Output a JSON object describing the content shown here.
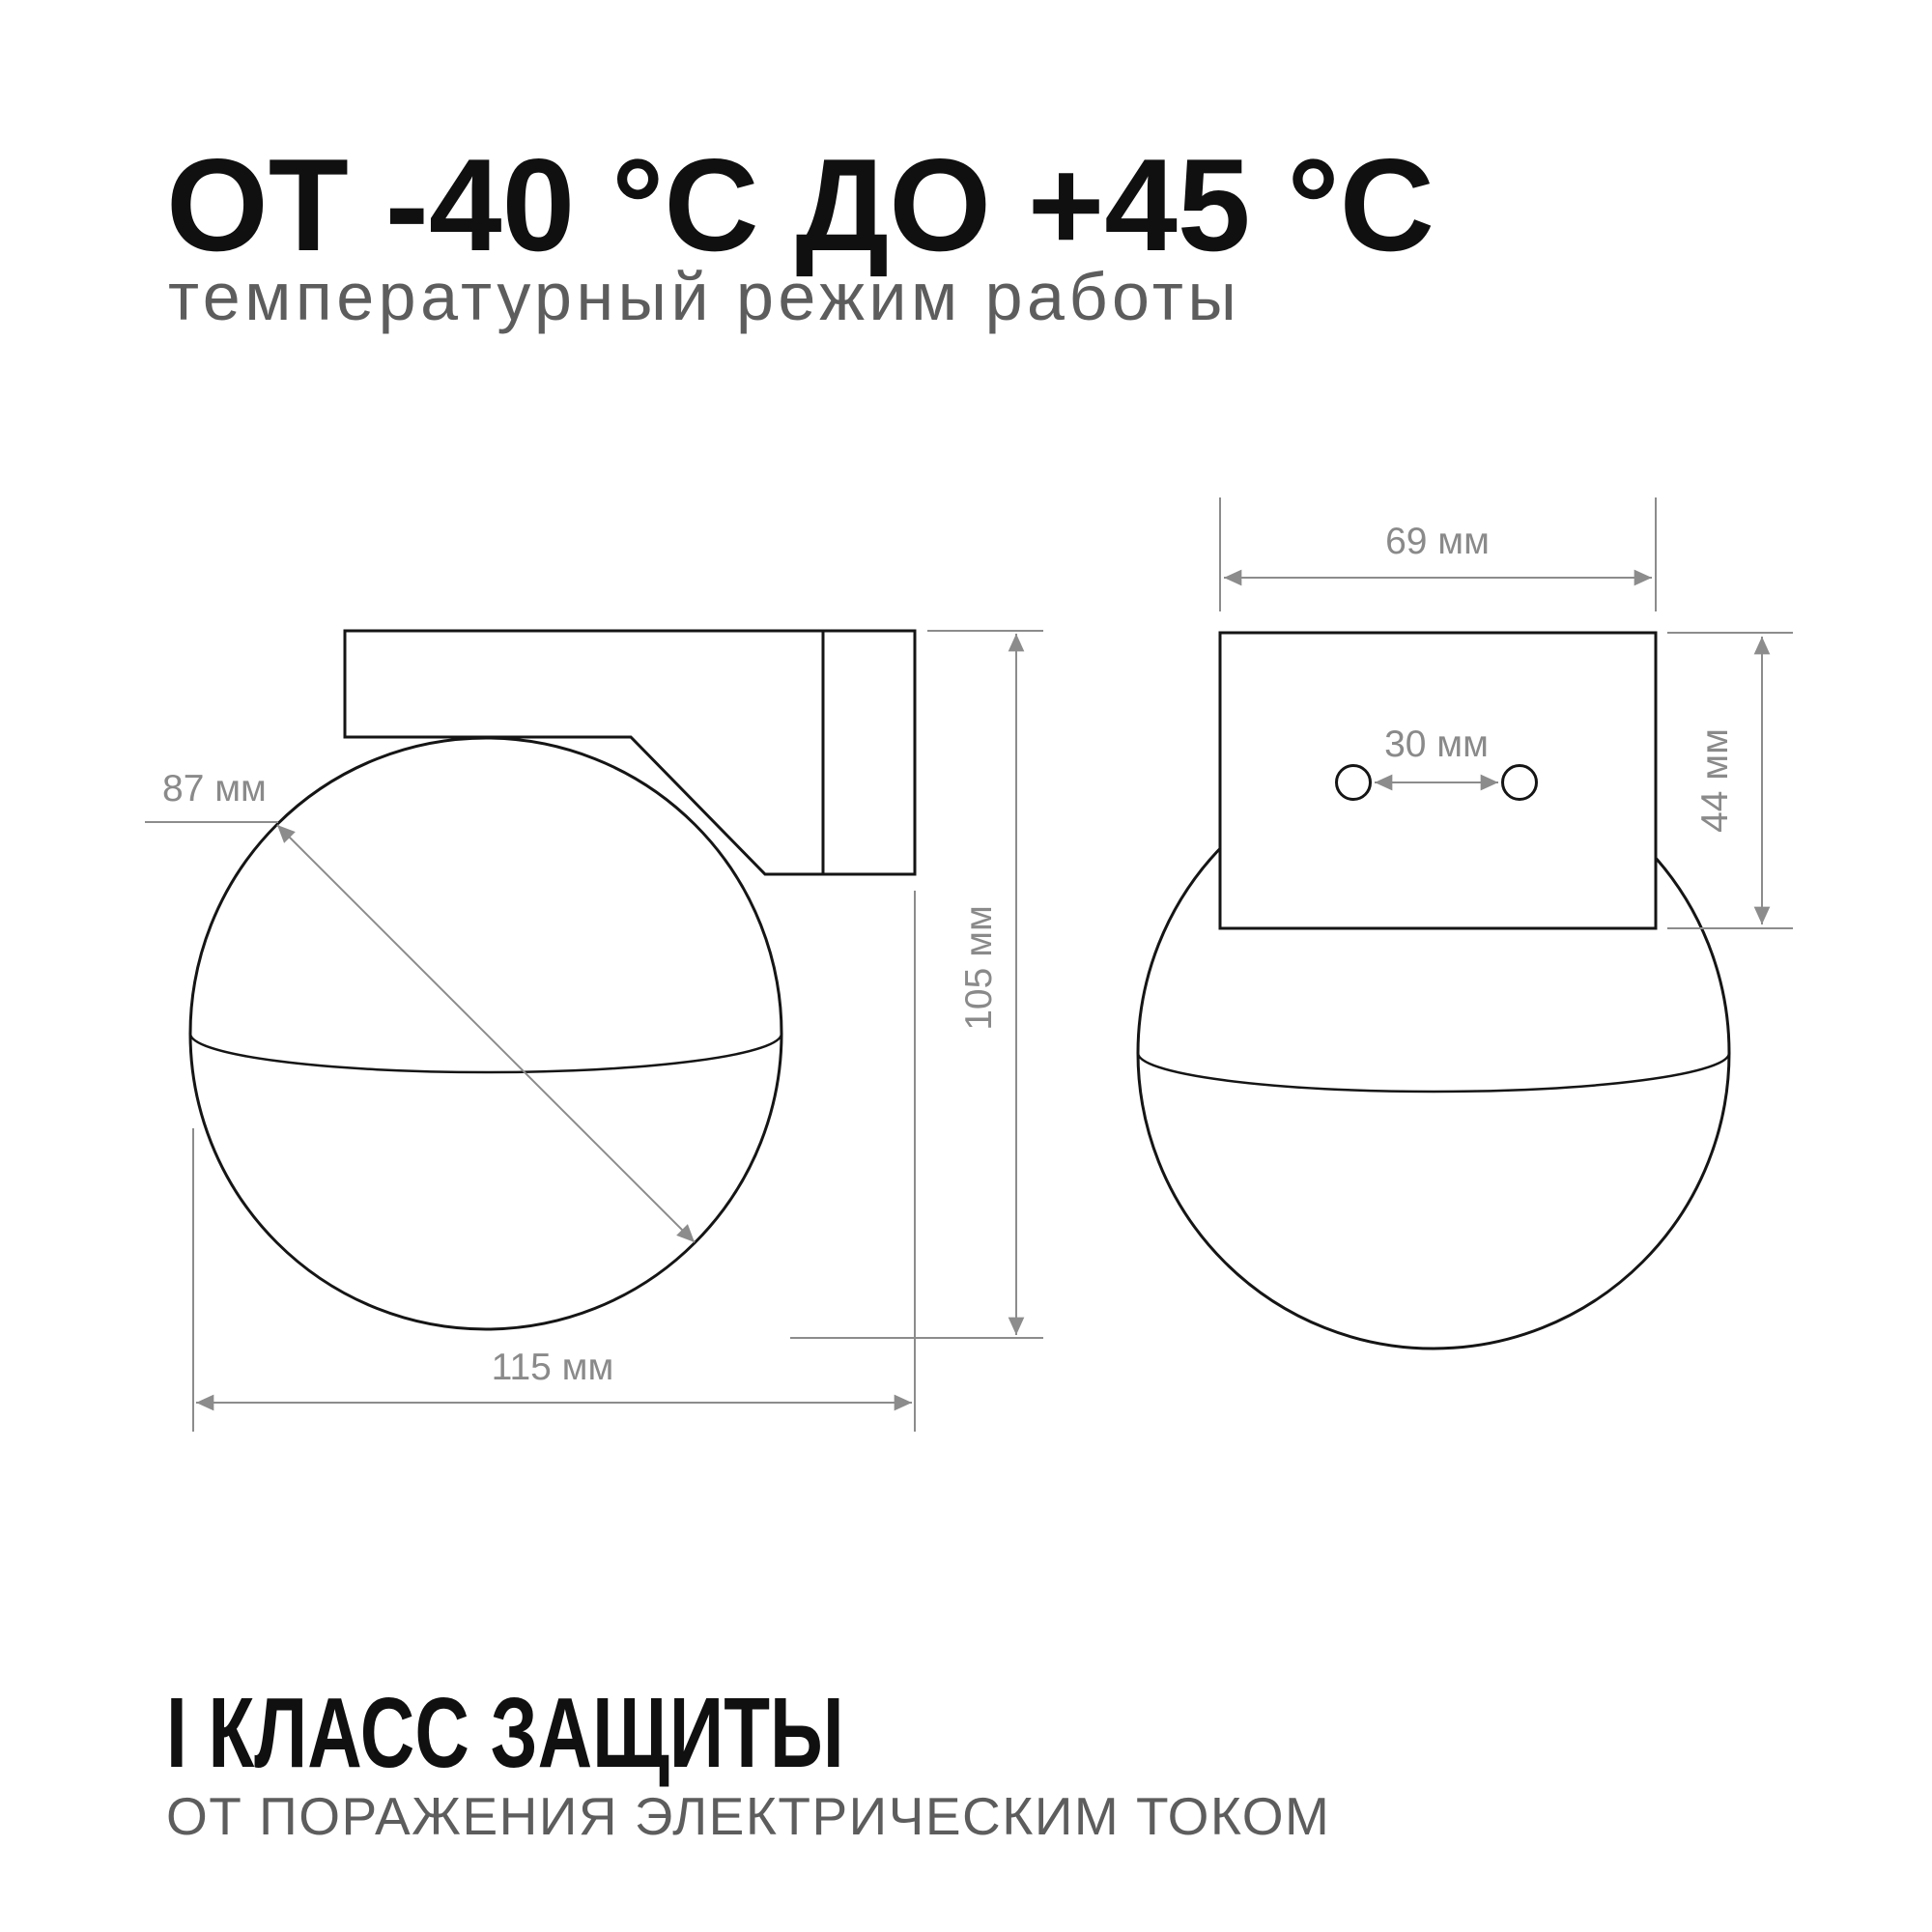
{
  "header": {
    "title": "ОТ -40 °C ДО +45 °C",
    "subtitle": "температурный режим работы"
  },
  "footer": {
    "title": "I КЛАСС ЗАЩИТЫ",
    "subtitle": "ОТ ПОРАЖЕНИЯ ЭЛЕКТРИЧЕСКИМ ТОКОМ"
  },
  "drawings": {
    "side_view": {
      "description": "wall lamp side view",
      "dims": {
        "globe_diameter": "87 мм",
        "overall_height": "105 мм",
        "overall_width": "115 мм"
      }
    },
    "front_view": {
      "description": "wall lamp front view",
      "dims": {
        "bracket_width": "69 мм",
        "hole_spacing": "30 мм",
        "bracket_height": "44 мм"
      }
    }
  },
  "colors": {
    "background": "#ffffff",
    "outline_black": "#151515",
    "dimension_gray": "#8c8c8c",
    "label_gray": "#8a8a8a",
    "heading_black": "#101010",
    "subtitle_gray": "#5d5d5d"
  }
}
